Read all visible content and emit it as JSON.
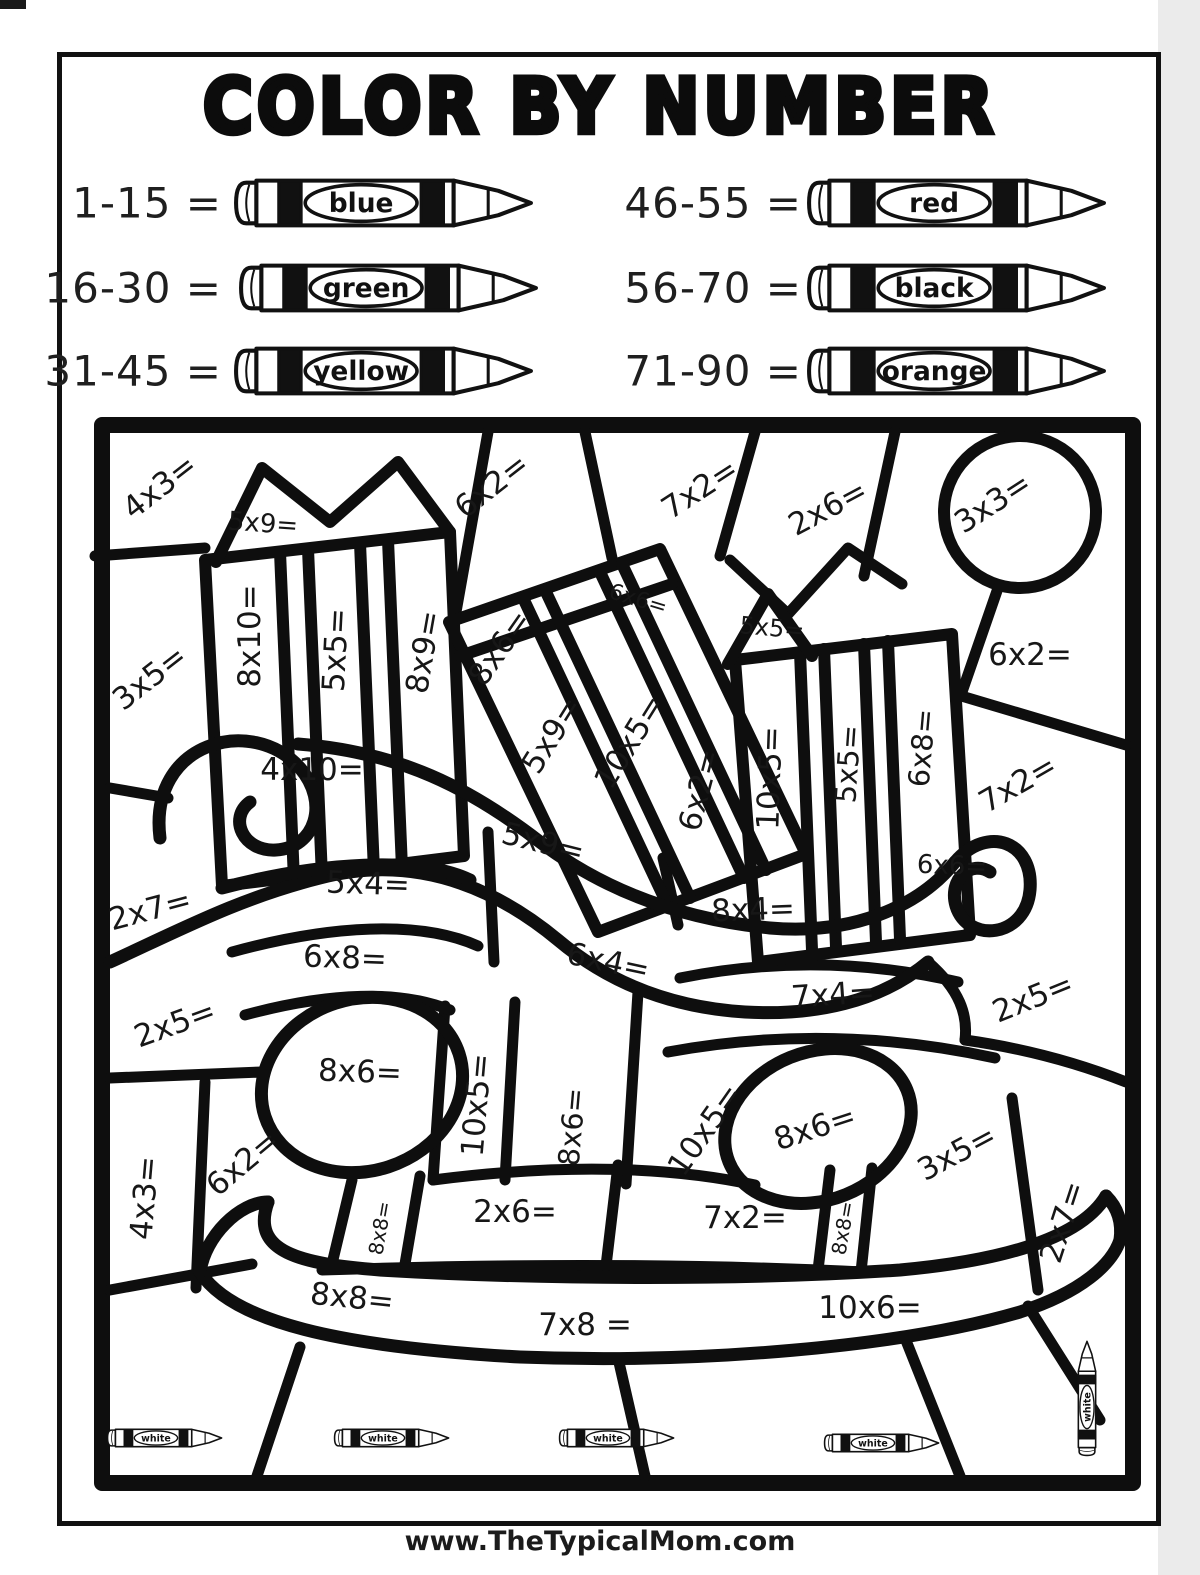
{
  "title": "COLOR BY NUMBER",
  "legend": {
    "left": [
      {
        "range": "1-15 =",
        "color_name": "blue"
      },
      {
        "range": "16-30 =",
        "color_name": "green"
      },
      {
        "range": "31-45 =",
        "color_name": "yellow"
      }
    ],
    "right": [
      {
        "range": "46-55 =",
        "color_name": "red"
      },
      {
        "range": "56-70 =",
        "color_name": "black"
      },
      {
        "range": "71-90 =",
        "color_name": "orange"
      }
    ]
  },
  "puzzle": {
    "white_label": "white",
    "problems": [
      {
        "text": "4x3=",
        "x": 160,
        "y": 487,
        "r": -38,
        "s": 31
      },
      {
        "text": "5x9=",
        "x": 263,
        "y": 524,
        "r": 4,
        "s": 26
      },
      {
        "text": "6x2=",
        "x": 492,
        "y": 486,
        "r": -38,
        "s": 31
      },
      {
        "text": "7x2=",
        "x": 700,
        "y": 489,
        "r": -33,
        "s": 31
      },
      {
        "text": "2x6=",
        "x": 828,
        "y": 508,
        "r": -28,
        "s": 31
      },
      {
        "text": "3x3=",
        "x": 993,
        "y": 503,
        "r": -33,
        "s": 31
      },
      {
        "text": "3x5=",
        "x": 150,
        "y": 678,
        "r": -38,
        "s": 31
      },
      {
        "text": "8x10=",
        "x": 250,
        "y": 636,
        "r": -90,
        "s": 31
      },
      {
        "text": "5x5=",
        "x": 336,
        "y": 650,
        "r": -87,
        "s": 31
      },
      {
        "text": "8x9=",
        "x": 424,
        "y": 652,
        "r": -80,
        "s": 31
      },
      {
        "text": "8x6=",
        "x": 500,
        "y": 648,
        "r": -55,
        "s": 31
      },
      {
        "text": "5x9=",
        "x": 552,
        "y": 735,
        "r": -58,
        "s": 31
      },
      {
        "text": "10x5=",
        "x": 630,
        "y": 742,
        "r": -58,
        "s": 31
      },
      {
        "text": "6x6=",
        "x": 638,
        "y": 600,
        "r": 17,
        "s": 22
      },
      {
        "text": "5x5=",
        "x": 772,
        "y": 628,
        "r": 5,
        "s": 24
      },
      {
        "text": "6x2=",
        "x": 1030,
        "y": 655,
        "r": 0,
        "s": 31
      },
      {
        "text": "6x2=",
        "x": 700,
        "y": 790,
        "r": -75,
        "s": 31
      },
      {
        "text": "10x5=",
        "x": 770,
        "y": 778,
        "r": -88,
        "s": 31
      },
      {
        "text": "5x5=",
        "x": 848,
        "y": 764,
        "r": -86,
        "s": 29
      },
      {
        "text": "6x8=",
        "x": 922,
        "y": 748,
        "r": -85,
        "s": 29
      },
      {
        "text": "7x2=",
        "x": 1018,
        "y": 784,
        "r": -30,
        "s": 31
      },
      {
        "text": "4x10=",
        "x": 312,
        "y": 770,
        "r": 0,
        "s": 31
      },
      {
        "text": "5x9=",
        "x": 543,
        "y": 843,
        "r": 14,
        "s": 31
      },
      {
        "text": "5x4=",
        "x": 368,
        "y": 884,
        "r": 2,
        "s": 31
      },
      {
        "text": "2x7=",
        "x": 150,
        "y": 910,
        "r": -15,
        "s": 31
      },
      {
        "text": "6x8=",
        "x": 345,
        "y": 958,
        "r": 2,
        "s": 31
      },
      {
        "text": "6x4=",
        "x": 608,
        "y": 962,
        "r": 12,
        "s": 31
      },
      {
        "text": "8x4=",
        "x": 753,
        "y": 910,
        "r": -2,
        "s": 31
      },
      {
        "text": "6x6=",
        "x": 952,
        "y": 866,
        "r": 2,
        "s": 26
      },
      {
        "text": "7x4=",
        "x": 833,
        "y": 995,
        "r": -4,
        "s": 31
      },
      {
        "text": "2x5=",
        "x": 1033,
        "y": 998,
        "r": -22,
        "s": 31
      },
      {
        "text": "2x5=",
        "x": 175,
        "y": 1024,
        "r": -20,
        "s": 31
      },
      {
        "text": "8x6=",
        "x": 360,
        "y": 1072,
        "r": 2,
        "s": 31
      },
      {
        "text": "10x5=",
        "x": 477,
        "y": 1105,
        "r": -85,
        "s": 31
      },
      {
        "text": "8x6=",
        "x": 572,
        "y": 1127,
        "r": -85,
        "s": 29
      },
      {
        "text": "10x5=",
        "x": 705,
        "y": 1130,
        "r": -55,
        "s": 31
      },
      {
        "text": "8x6=",
        "x": 815,
        "y": 1128,
        "r": -18,
        "s": 31
      },
      {
        "text": "3x5=",
        "x": 957,
        "y": 1153,
        "r": -28,
        "s": 31
      },
      {
        "text": "4x3=",
        "x": 145,
        "y": 1198,
        "r": -85,
        "s": 31
      },
      {
        "text": "6x2=",
        "x": 243,
        "y": 1163,
        "r": -40,
        "s": 31
      },
      {
        "text": "8x8=",
        "x": 380,
        "y": 1228,
        "r": -80,
        "s": 20
      },
      {
        "text": "2x6=",
        "x": 515,
        "y": 1212,
        "r": 0,
        "s": 31
      },
      {
        "text": "7x2=",
        "x": 745,
        "y": 1218,
        "r": 0,
        "s": 31
      },
      {
        "text": "8x8=",
        "x": 843,
        "y": 1228,
        "r": -80,
        "s": 20
      },
      {
        "text": "2x7=",
        "x": 1063,
        "y": 1222,
        "r": -72,
        "s": 31
      },
      {
        "text": "8x8=",
        "x": 352,
        "y": 1298,
        "r": 6,
        "s": 31
      },
      {
        "text": "7x8 =",
        "x": 585,
        "y": 1325,
        "r": 0,
        "s": 31
      },
      {
        "text": "10x6=",
        "x": 870,
        "y": 1308,
        "r": 0,
        "s": 31
      }
    ],
    "white_crayons_horizontal": [
      {
        "x": 165,
        "y": 1438
      },
      {
        "x": 392,
        "y": 1438
      },
      {
        "x": 617,
        "y": 1438
      },
      {
        "x": 882,
        "y": 1443
      }
    ],
    "white_crayons_vertical": [
      {
        "x": 1087,
        "y": 1398
      }
    ]
  },
  "footer": {
    "url": "www.TheTypicalMom.com"
  }
}
